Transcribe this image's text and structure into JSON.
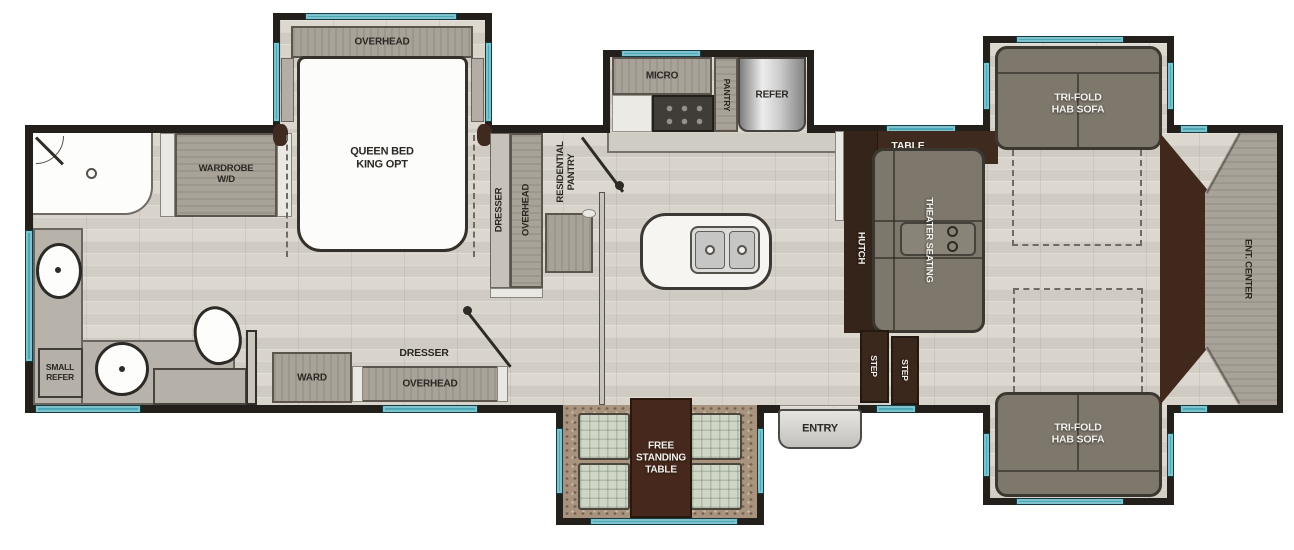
{
  "plan": {
    "bedroom": {
      "overhead": "OVERHEAD",
      "bed": "QUEEN BED\nKING OPT",
      "wardrobe": "WARDROBE\nW/D",
      "dresser_v": "DRESSER",
      "overhead_v": "OVERHEAD"
    },
    "bath": {
      "small_refer": "SMALL\nREFER"
    },
    "kitchen": {
      "micro": "MICRO",
      "pantry": "PANTRY",
      "refer": "REFER",
      "residential_pantry": "RESIDENTIAL\nPANTRY"
    },
    "hall": {
      "ward": "WARD",
      "dresser": "DRESSER",
      "overhead": "OVERHEAD"
    },
    "living": {
      "table": "TABLE",
      "hutch": "HUTCH",
      "theater_seating": "THEATER SEATING",
      "sofa_top": "TRI-FOLD\nHAB SOFA",
      "sofa_bottom": "TRI-FOLD\nHAB SOFA",
      "ent_center": "ENT. CENTER",
      "step_1": "STEP",
      "step_2": "STEP"
    },
    "dinette": {
      "free_standing_table": "FREE\nSTANDING\nTABLE"
    },
    "entry": "ENTRY"
  },
  "colors": {
    "wall": "#23201c",
    "floor": "#d8d4cb",
    "window_teal": "#4aa8b7",
    "cabinet_gray": "#a8a299",
    "dark_wood": "#3e2a1e",
    "sofa_gray": "#7d776c",
    "carpet": "#a8947e"
  }
}
